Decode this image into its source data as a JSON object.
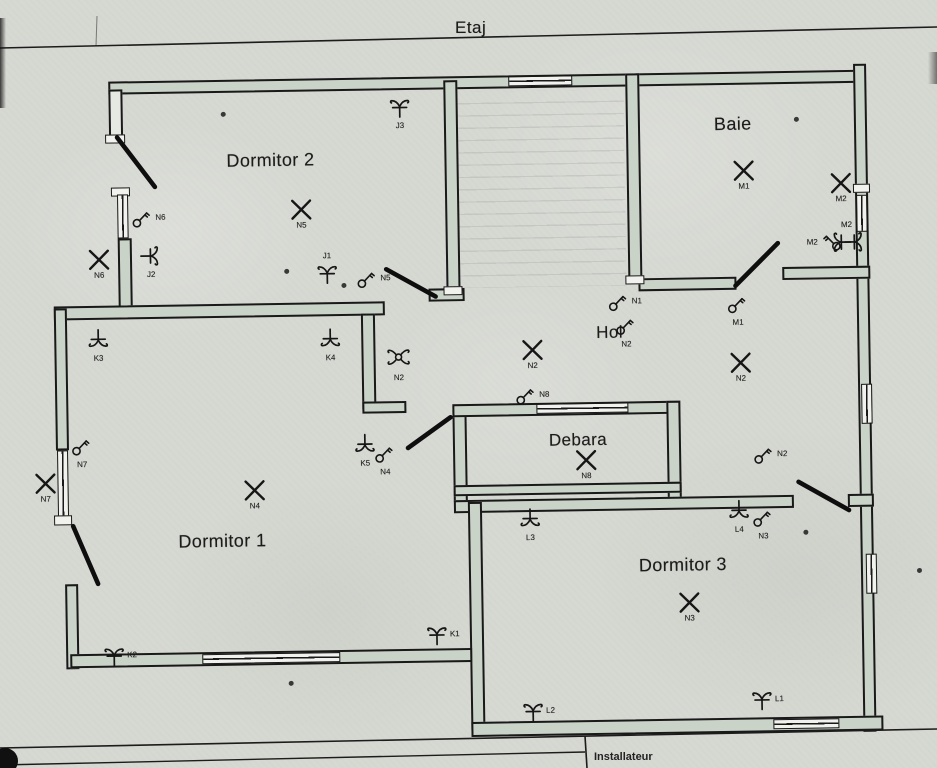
{
  "floor_label": "Etaj",
  "installer_label": "Installateur",
  "rooms": [
    {
      "id": "dormitor2",
      "name": "Dormitor 2"
    },
    {
      "id": "baie",
      "name": "Baie"
    },
    {
      "id": "hol",
      "name": "Hol"
    },
    {
      "id": "debara",
      "name": "Debara"
    },
    {
      "id": "dormitor1",
      "name": "Dormitor 1"
    },
    {
      "id": "dormitor3",
      "name": "Dormitor 3"
    }
  ],
  "symbols": {
    "lamps": [
      {
        "id": "n5",
        "label": "N5"
      },
      {
        "id": "n6",
        "label": "N6"
      },
      {
        "id": "m1",
        "label": "M1"
      },
      {
        "id": "m2",
        "label": "M2"
      },
      {
        "id": "n2-hol-center",
        "label": "N2"
      },
      {
        "id": "n2-hol-right",
        "label": "N2"
      },
      {
        "id": "n8",
        "label": "N8"
      },
      {
        "id": "n7",
        "label": "N7"
      },
      {
        "id": "n4",
        "label": "N4"
      },
      {
        "id": "n3",
        "label": "N3"
      }
    ],
    "serial_switches": [
      {
        "id": "j3",
        "label": "J3"
      },
      {
        "id": "j1",
        "label": "J1"
      },
      {
        "id": "j2",
        "label": "J2"
      },
      {
        "id": "k3",
        "label": "K3"
      },
      {
        "id": "k4",
        "label": "K4"
      },
      {
        "id": "k5",
        "label": "K5"
      },
      {
        "id": "l3",
        "label": "L3"
      },
      {
        "id": "l4",
        "label": "L4"
      },
      {
        "id": "k2",
        "label": "K2"
      },
      {
        "id": "k1",
        "label": "K1"
      },
      {
        "id": "l2",
        "label": "L2"
      },
      {
        "id": "l1",
        "label": "L1"
      },
      {
        "id": "m2-wall",
        "label": "M2"
      }
    ],
    "circle_switches": [
      {
        "id": "n6",
        "label": "N6"
      },
      {
        "id": "n5-dormitor2",
        "label": "N5"
      },
      {
        "id": "n1",
        "label": "N1"
      },
      {
        "id": "n2-stairs",
        "label": "N2"
      },
      {
        "id": "m1",
        "label": "M1"
      },
      {
        "id": "m2",
        "label": "M2"
      },
      {
        "id": "n8",
        "label": "N8"
      },
      {
        "id": "n7",
        "label": "N7"
      },
      {
        "id": "n4",
        "label": "N4"
      },
      {
        "id": "n2-corridor",
        "label": "N2"
      },
      {
        "id": "n3",
        "label": "N3"
      }
    ],
    "cross_switches": [
      {
        "id": "n2-cross",
        "label": "N2"
      }
    ]
  },
  "colors": {
    "paper": "#d6d8d2",
    "wall_fill": "#c9d3c8",
    "ink": "#1a1a1a"
  }
}
